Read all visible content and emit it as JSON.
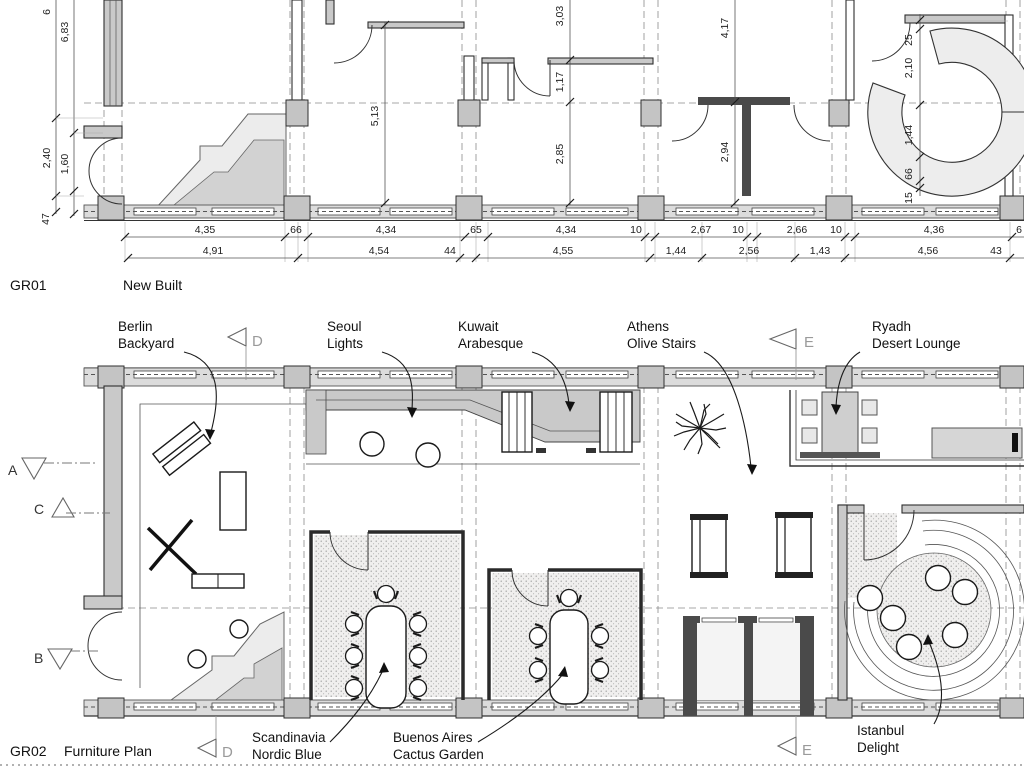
{
  "colors": {
    "wall_fill": "#c9c9c9",
    "band_fill": "#dcdcdc",
    "ramp_light": "#ececec",
    "ramp_mid": "#d2d2d2",
    "line": "#2a2a2a",
    "marker_letter": "#9a9a9a"
  },
  "gr01": {
    "code": "GR01",
    "title": "New Built",
    "vdims_outer": [
      "6",
      "2,40",
      "47"
    ],
    "vdims_inner": [
      "6,83",
      "1,60"
    ],
    "vdims_right": [
      "25",
      "2,10",
      "1,44",
      "66",
      "15"
    ],
    "vdims_interior": [
      "5,13",
      "3,03",
      "1,17",
      "2,85",
      "4,17",
      "2,94"
    ],
    "chain_row1": [
      "4,35",
      "66",
      "4,34",
      "65",
      "4,34",
      "10",
      "2,67",
      "10",
      "2,66",
      "10",
      "4,36",
      "6"
    ],
    "chain_row2": [
      "4,91",
      "4,54",
      "44",
      "4,55",
      "1,44",
      "2,56",
      "1,43",
      "4,56",
      "43"
    ]
  },
  "gr02": {
    "code": "GR02",
    "title": "Furniture Plan",
    "rooms": {
      "berlin": {
        "line1": "Berlin",
        "line2": "Backyard"
      },
      "seoul": {
        "line1": "Seoul",
        "line2": "Lights"
      },
      "kuwait": {
        "line1": "Kuwait",
        "line2": "Arabesque"
      },
      "athens": {
        "line1": "Athens",
        "line2": "Olive Stairs"
      },
      "ryadh": {
        "line1": "Ryadh",
        "line2": "Desert Lounge"
      },
      "scandinavia": {
        "line1": "Scandinavia",
        "line2": "Nordic Blue"
      },
      "buenos_aires": {
        "line1": "Buenos Aires",
        "line2": "Cactus Garden"
      },
      "istanbul": {
        "line1": "Istanbul",
        "line2": "Delight"
      }
    },
    "markers": {
      "a": "A",
      "b": "B",
      "c": "C",
      "d": "D",
      "e": "E"
    }
  }
}
